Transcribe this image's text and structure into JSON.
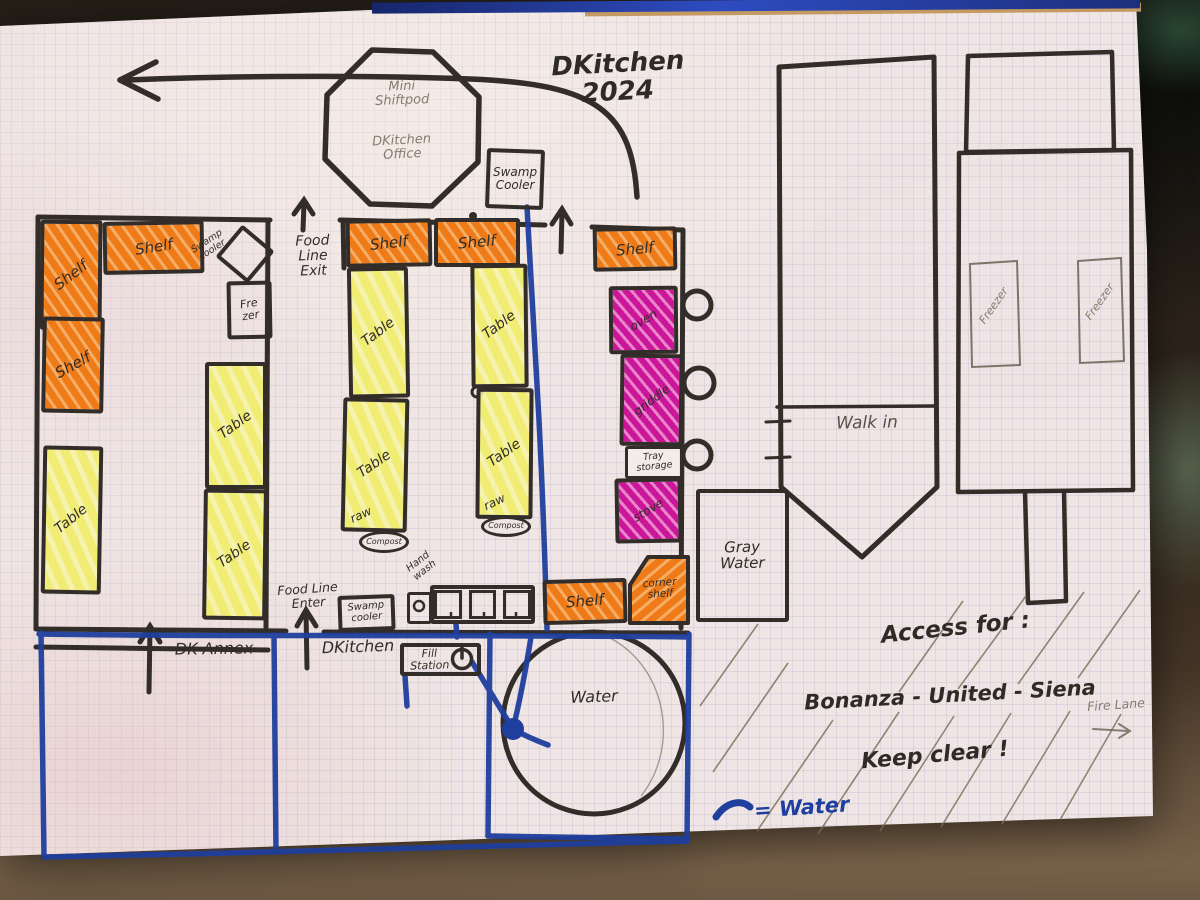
{
  "title": "DKitchen\n2024",
  "pod": {
    "top": "Mini\nShiftpod",
    "bottom": "DKitchen\nOffice"
  },
  "equipment": {
    "shelf": "Shelf",
    "corner_shelf": "corner\nshelf",
    "table": "Table",
    "raw": "raw",
    "compost": "Compost",
    "swamp_cooler_top": "Swamp\nCooler",
    "swamp_cooler_small": "Swamp\ncooler",
    "swamp_cooler_bottom": "Swamp\ncooler",
    "freezer_small": "Fre\nzer",
    "freezer": "Freezer",
    "oven": "oven",
    "griddle": "griddle",
    "tray_storage": "Tray\nstorage",
    "stove": "stove",
    "fill_station": "Fill\nStation",
    "hand_wash": "Hand\nwash"
  },
  "areas": {
    "walk_in": "Walk in",
    "gray_water": "Gray\nWater",
    "water": "Water",
    "dk_annex": "DK Annex",
    "dkitchen": "DKitchen"
  },
  "flow": {
    "food_line_exit": "Food\nLine\nExit",
    "food_line_enter": "Food Line\nEnter"
  },
  "notes": {
    "access_for": "Access for :",
    "access_names": "Bonanza - United - Siena",
    "keep_clear": "Keep clear !",
    "fire_lane": "Fire Lane",
    "water_legend": "= Water"
  },
  "colors": {
    "ink": "#322d28",
    "pencil": "#847c6f",
    "marker_orange": "#ee7b17",
    "marker_yellow": "#f0ed6e",
    "marker_magenta": "#cb169a",
    "water_blue": "#1f3f9e",
    "paper": "#efe5e4"
  }
}
